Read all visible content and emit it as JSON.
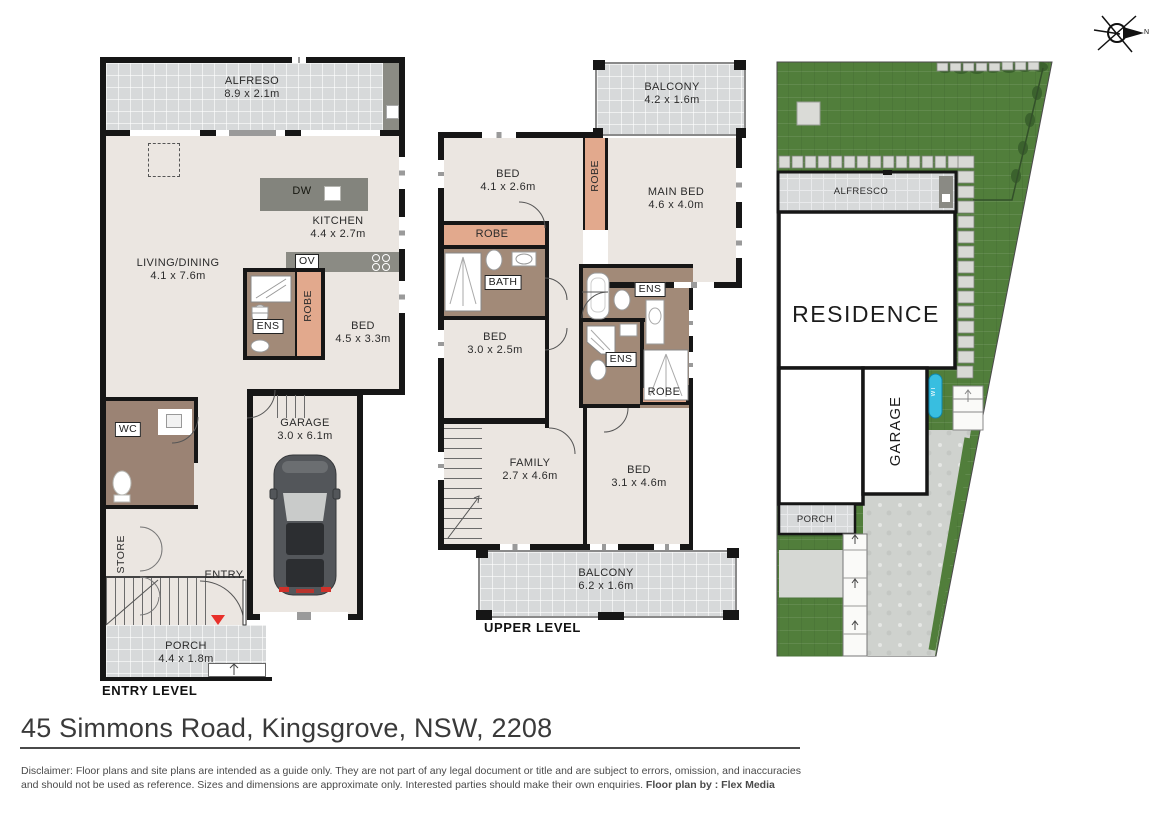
{
  "footer": {
    "address": "45 Simmons Road, Kingsgrove, NSW, 2208",
    "disclaimer_line1": "Disclaimer: Floor plans and site plans are intended as a guide only. They are not part of any legal document or title and are subject to errors, omission, and inaccuracies",
    "disclaimer_line2": "and should not be used as reference. Sizes and dimensions are approximate only. Interested parties should make their own enquiries. ",
    "credit": "Floor plan by : Flex Media"
  },
  "compass": {
    "north_label": "N"
  },
  "entry_level": {
    "caption": "ENTRY LEVEL",
    "alfresco": {
      "name": "ALFRESO",
      "dims": "8.9 x 2.1m"
    },
    "kitchen": {
      "name": "KITCHEN",
      "dims": "4.4 x 2.7m",
      "dishwasher": "DW",
      "oven": "OV"
    },
    "living": {
      "name": "LIVING/DINING",
      "dims": "4.1 x 7.6m"
    },
    "ens": {
      "name": "ENS"
    },
    "robe": {
      "name": "ROBE"
    },
    "bed": {
      "name": "BED",
      "dims": "4.5 x 3.3m"
    },
    "wc": {
      "name": "WC"
    },
    "store": {
      "name": "STORE"
    },
    "garage": {
      "name": "GARAGE",
      "dims": "3.0 x 6.1m"
    },
    "entry": {
      "name": "ENTRY"
    },
    "porch": {
      "name": "PORCH",
      "dims": "4.4 x 1.8m"
    }
  },
  "upper_level": {
    "caption": "UPPER LEVEL",
    "balcony_top": {
      "name": "BALCONY",
      "dims": "4.2 x 1.6m"
    },
    "bed1": {
      "name": "BED",
      "dims": "4.1 x 2.6m"
    },
    "main_bed": {
      "name": "MAIN BED",
      "dims": "4.6 x 4.0m"
    },
    "robe_vertical": {
      "name": "ROBE"
    },
    "robe_horizontal": {
      "name": "ROBE"
    },
    "robe_main": {
      "name": "ROBE"
    },
    "bath": {
      "name": "BATH"
    },
    "bed2": {
      "name": "BED",
      "dims": "3.0 x 2.5m"
    },
    "ens1": {
      "name": "ENS"
    },
    "ens2": {
      "name": "ENS"
    },
    "family": {
      "name": "FAMILY",
      "dims": "2.7 x 4.6m"
    },
    "bed3": {
      "name": "BED",
      "dims": "3.1 x 4.6m"
    },
    "balcony_bottom": {
      "name": "BALCONY",
      "dims": "6.2 x 1.6m"
    }
  },
  "site_plan": {
    "alfresco": "ALFRESCO",
    "residence": "RESIDENCE",
    "garage": "GARAGE",
    "porch": "PORCH",
    "water_tank": "WT"
  },
  "colors": {
    "wall": "#161616",
    "floor": "#ebe6e1",
    "tile": "#d7d9da",
    "counter_grey": "#8b8b84",
    "robe_salmon": "#e2a98d",
    "bathroom_taupe": "#a28a78",
    "grass_green": "#517e3b",
    "concrete": "#cfd2ce",
    "water_tank_blue": "#38bee0",
    "entry_marker_red": "#e8302a"
  }
}
